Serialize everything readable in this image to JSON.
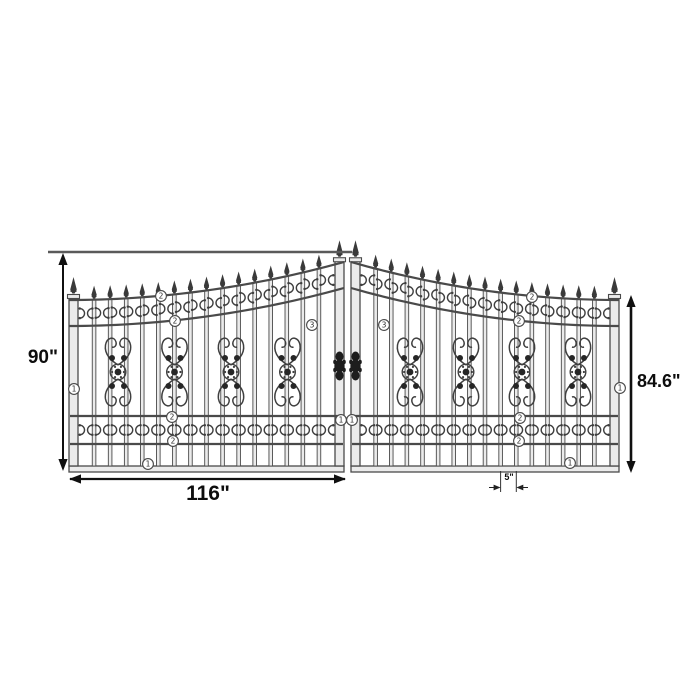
{
  "diagram": {
    "dimensions": {
      "left_height": "90\"",
      "right_height": "84.6\"",
      "gate_panel_width": "116\"",
      "picket_spacing": "5\""
    },
    "callouts": [
      {
        "label": "1",
        "x": 74,
        "y": 389
      },
      {
        "label": "1",
        "x": 148,
        "y": 464
      },
      {
        "label": "2",
        "x": 161,
        "y": 296
      },
      {
        "label": "2",
        "x": 175,
        "y": 321
      },
      {
        "label": "2",
        "x": 172,
        "y": 417
      },
      {
        "label": "2",
        "x": 173,
        "y": 441
      },
      {
        "label": "3",
        "x": 312,
        "y": 325
      },
      {
        "label": "1",
        "x": 341,
        "y": 420
      },
      {
        "label": "1",
        "x": 352,
        "y": 420
      },
      {
        "label": "3",
        "x": 384,
        "y": 325
      },
      {
        "label": "2",
        "x": 532,
        "y": 297
      },
      {
        "label": "2",
        "x": 519,
        "y": 321
      },
      {
        "label": "2",
        "x": 520,
        "y": 418
      },
      {
        "label": "2",
        "x": 519,
        "y": 441
      },
      {
        "label": "1",
        "x": 620,
        "y": 388
      },
      {
        "label": "1",
        "x": 570,
        "y": 463
      }
    ],
    "colors": {
      "line": "#4a4a4a",
      "bar_fill": "#ebebeb",
      "ornament": "#3f3f3f",
      "hardware": "#1d1d1d",
      "dimension": "#101010",
      "extension": "#5a5a5a",
      "background": "#ffffff"
    }
  }
}
